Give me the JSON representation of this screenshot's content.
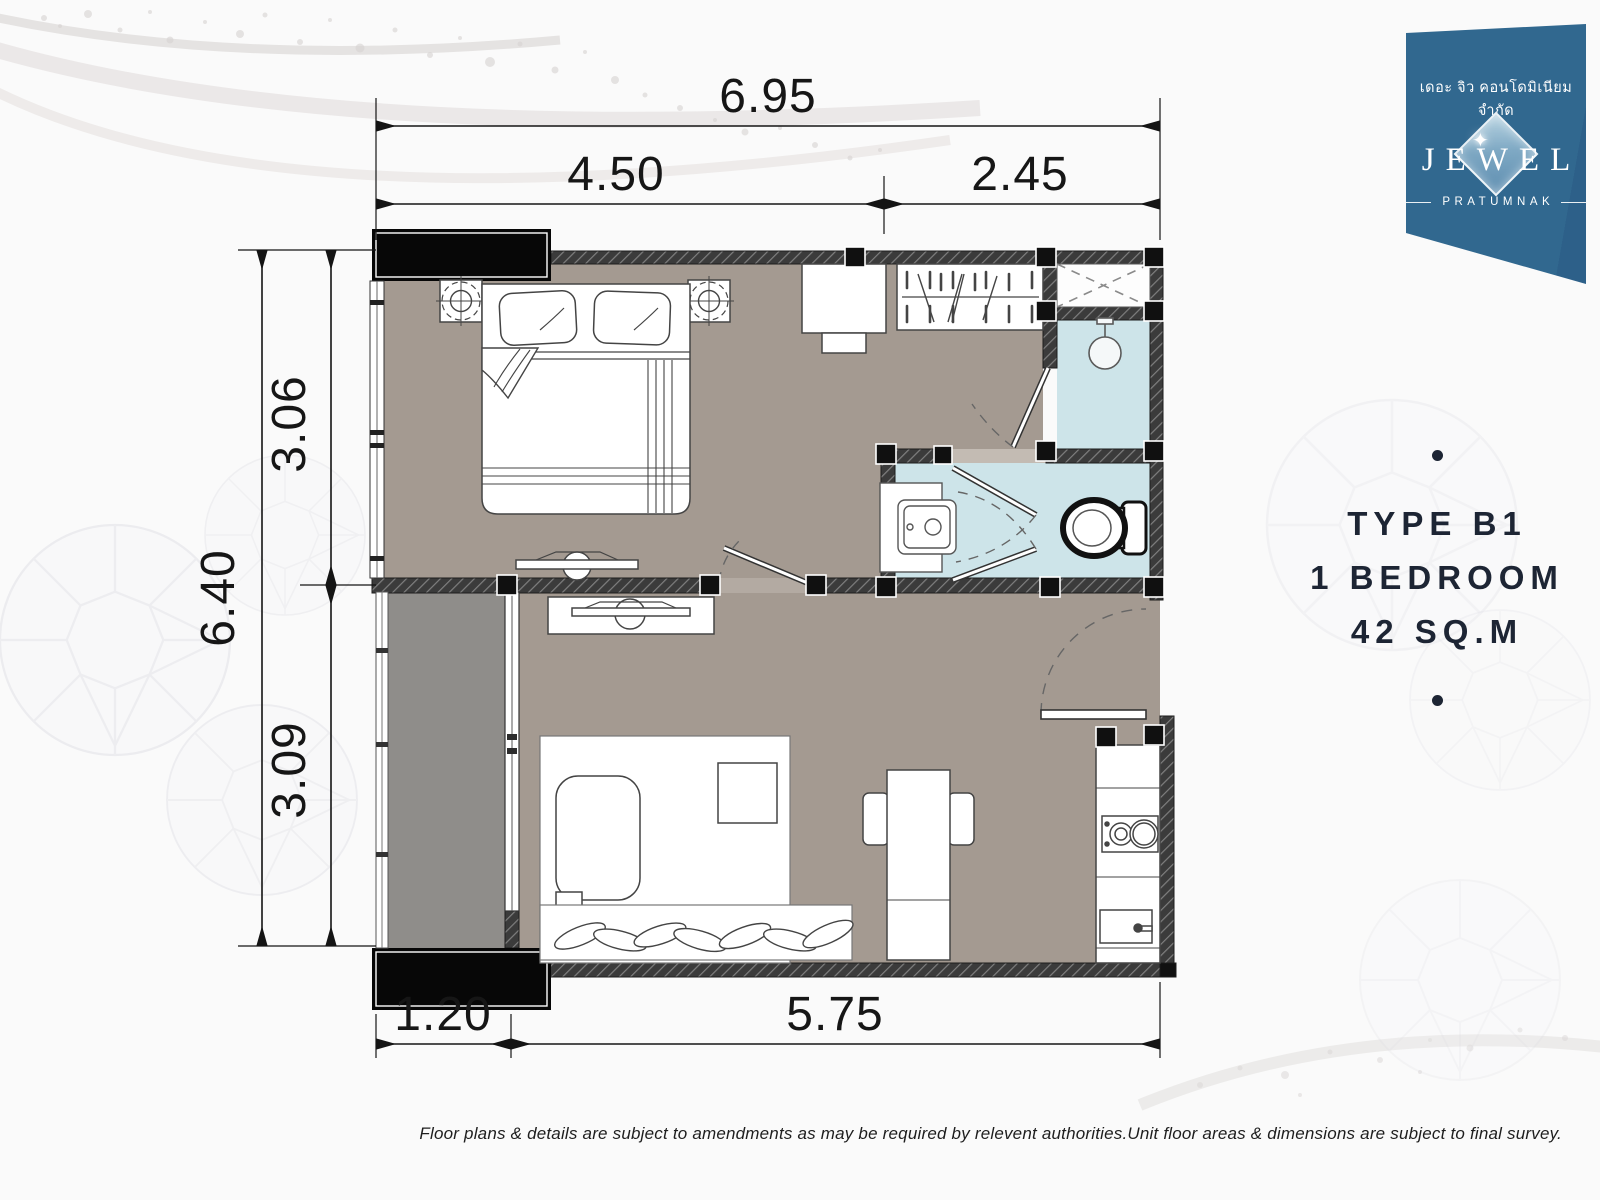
{
  "logo": {
    "company_line": "เดอะ จิว คอนโดมิเนียม จำกัด",
    "brand": "JEWEL",
    "subtitle": "PRATUMNAK",
    "sparkle_icon": "diamond-sparkle"
  },
  "unit_info": {
    "type": "TYPE B1",
    "bedroom": "1 BEDROOM",
    "area": "42 SQ.M"
  },
  "dimensions": {
    "top_total": "6.95",
    "top_left_segment": "4.50",
    "top_right_segment": "2.45",
    "left_total": "6.40",
    "left_upper_segment": "3.06",
    "left_lower_segment": "3.09",
    "bottom_left_segment": "1.20",
    "bottom_right_segment": "5.75"
  },
  "disclaimer": "Floor plans & details are subject to amendments as may be required by relevent authorities.Unit floor areas & dimensions are subject to final survey.",
  "colors": {
    "floor": "#a49a91",
    "balcony_floor": "#8f8d8a",
    "wet_area": "#cde4e9",
    "wall": "#3b3b3b",
    "accent_navy": "#1d2534",
    "banner_blue": "#31688f"
  }
}
